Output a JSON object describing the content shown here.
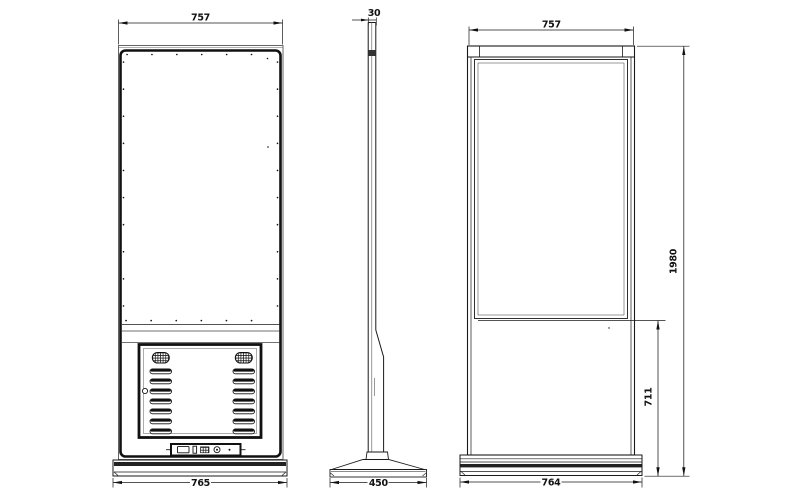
{
  "views": {
    "back": {
      "dim_top": "757",
      "dim_bottom": "765"
    },
    "side": {
      "dim_top": "30",
      "dim_bottom": "450"
    },
    "front": {
      "dim_top": "757",
      "dim_bottom": "764",
      "dim_height": "1980",
      "dim_screen_bottom": "711"
    }
  },
  "colors": {
    "line": "#1a1a1a",
    "background": "#ffffff",
    "fill_dark": "#222222"
  },
  "icons": {
    "speaker-grille-icon": "crosshatched rounded oval",
    "vent-louver-icon": "horizontal slot bar",
    "lock-hole-icon": "small circle",
    "vga-port-icon": "outlined rectangle",
    "usb-port-icon": "small vertical rectangle",
    "dot-grid-port-icon": "crosshatched square",
    "power-port-icon": "circle with center dot",
    "indicator-dot-icon": "filled dot"
  }
}
